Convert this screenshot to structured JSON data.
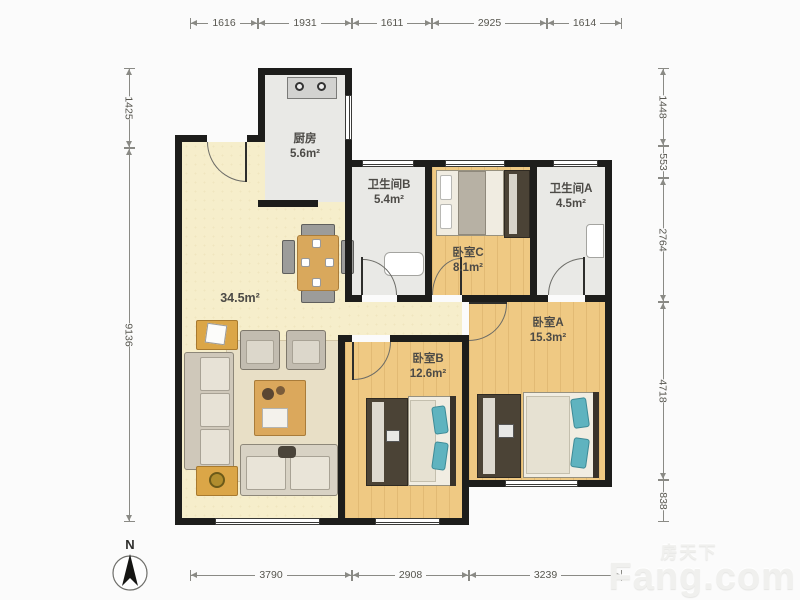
{
  "compass": {
    "label": "N"
  },
  "watermark": {
    "cn": "房天下",
    "brand": "Fang.com"
  },
  "rooms": {
    "kitchen": {
      "name": "厨房",
      "area": "5.6m²"
    },
    "bath_b": {
      "name": "卫生间B",
      "area": "5.4m²"
    },
    "bath_a": {
      "name": "卫生间A",
      "area": "4.5m²"
    },
    "bed_c": {
      "name": "卧室C",
      "area": "8.1m²"
    },
    "bed_a": {
      "name": "卧室A",
      "area": "15.3m²"
    },
    "bed_b": {
      "name": "卧室B",
      "area": "12.6m²"
    },
    "living": {
      "area": "34.5m²"
    }
  },
  "dimensions": {
    "top": [
      "1616",
      "1931",
      "1611",
      "2925",
      "1614"
    ],
    "left": [
      "1425",
      "9136"
    ],
    "right": [
      "1448",
      "553",
      "2764",
      "4718",
      "838"
    ],
    "bottom": [
      "3790",
      "2908",
      "3239"
    ]
  },
  "colors": {
    "wall": "#1d1d1b",
    "wood_floor": "#efc983",
    "tile_floor": "#e9e9e6",
    "living_floor": "#f6eecb",
    "teal_accent": "#5fb3bf",
    "table_tan": "#d9a85c"
  }
}
